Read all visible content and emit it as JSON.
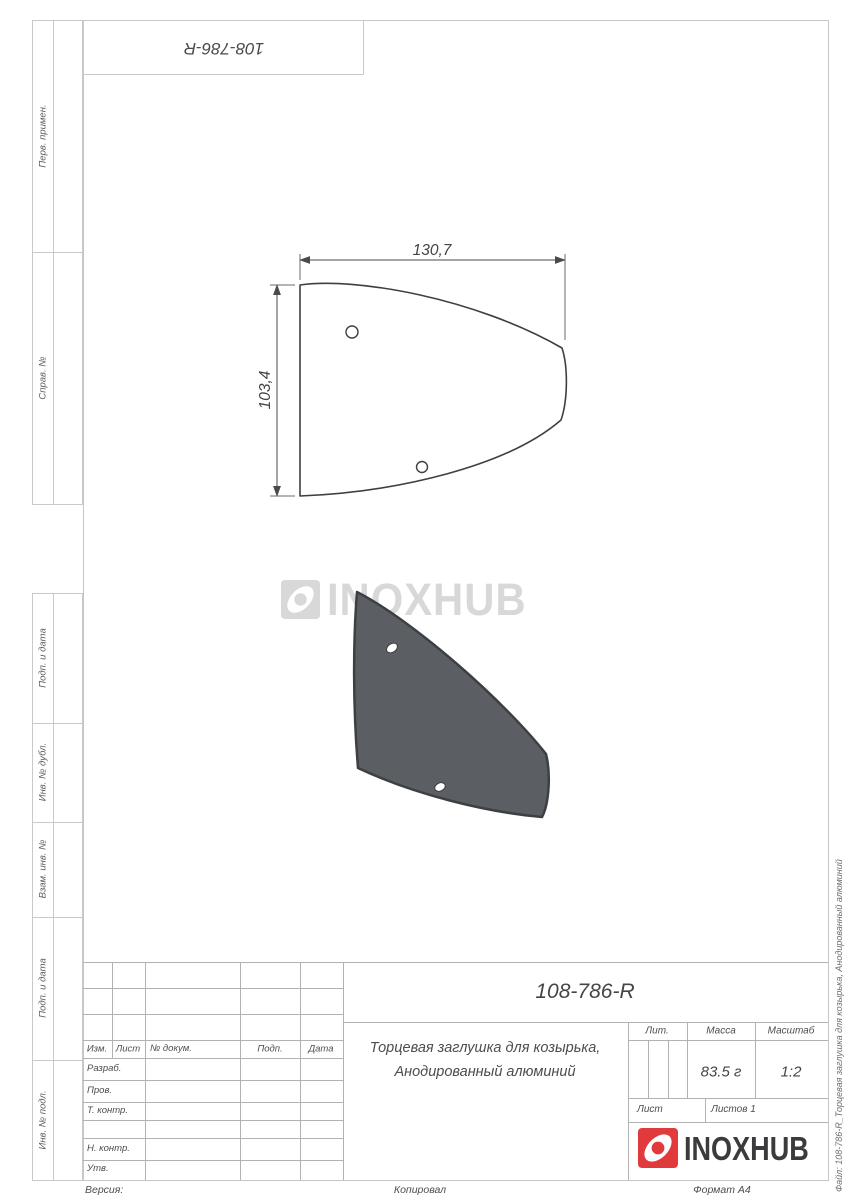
{
  "corner_stamp": "108-786-R",
  "sidebar": {
    "items": [
      {
        "label": "Перв. примен."
      },
      {
        "label": "Справ. №"
      },
      {
        "label": "Подп. и дата"
      },
      {
        "label": "Инв. № дубл."
      },
      {
        "label": "Взам. инв. №"
      },
      {
        "label": "Подп. и дата"
      },
      {
        "label": "Инв. № подл."
      }
    ]
  },
  "drawing": {
    "dim_width": "130,7",
    "dim_height": "103,4"
  },
  "watermark": {
    "text": "INOXHUB"
  },
  "title_block": {
    "part_number": "108-786-R",
    "name_line1": "Торцевая заглушка для козырька,",
    "name_line2": "Анодированный алюминий",
    "lit_label": "Лит.",
    "mass_label": "Масса",
    "scale_label": "Масштаб",
    "mass_value": "83.5 г",
    "scale_value": "1:2",
    "sheet_label": "Лист",
    "sheets_label": "Листов 1",
    "header": {
      "izm": "Изм.",
      "list": "Лист",
      "doc": "№ докум.",
      "sign": "Подп.",
      "date": "Дата"
    },
    "rows": [
      "Разраб.",
      "Пров.",
      "Т. контр.",
      "Н. контр.",
      "Утв."
    ]
  },
  "logo": {
    "text": "INOXHUB"
  },
  "page_margin": {
    "version": "Версия:",
    "copied": "Копировал",
    "format": "Формат А4"
  },
  "file_label": "Файл: 108-786-R_Торцевая заглушка для козырька, Анодированный алюминий",
  "colors": {
    "logo_red": "#e03a3c",
    "part_fill": "#5b5f63",
    "part_stroke": "#3d4043",
    "watermark_gray": "#d8d8d8",
    "frame_line": "#c6c6c6",
    "table_line": "#b2b2b2",
    "text": "#4d4d4d"
  }
}
